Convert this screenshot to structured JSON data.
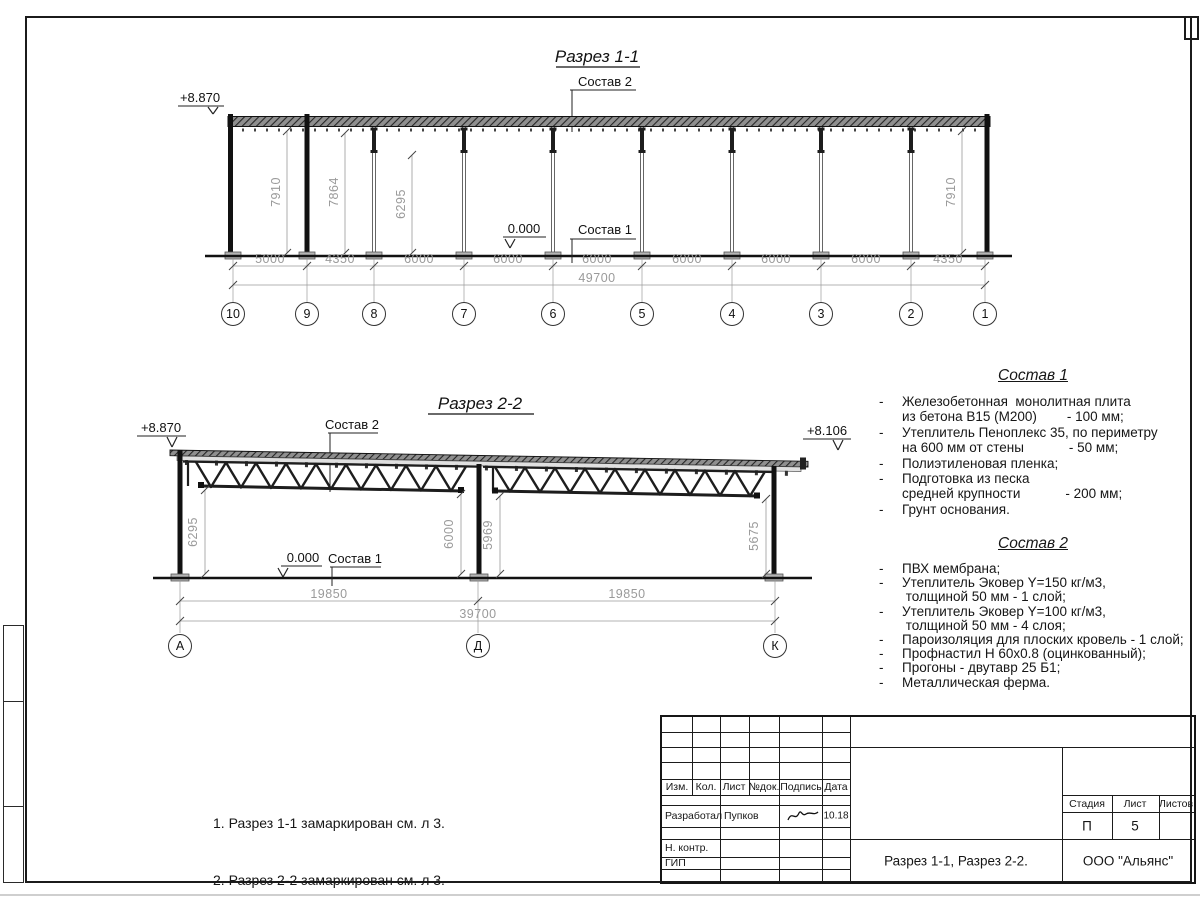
{
  "section11": {
    "title": "Разрез 1-1",
    "leader_top": "Состав 2",
    "leader_floor": "Состав 1",
    "elev_top": "+8.870",
    "elev_zero": "0.000",
    "dims_vertical": [
      "7910",
      "7864",
      "6295",
      "7910"
    ],
    "dims_bottom": [
      "5000",
      "4350",
      "6000",
      "6000",
      "6000",
      "6000",
      "6000",
      "6000",
      "4350"
    ],
    "dim_total": "49700",
    "axes": [
      "10",
      "9",
      "8",
      "7",
      "6",
      "5",
      "4",
      "3",
      "2",
      "1"
    ]
  },
  "section22": {
    "title": "Разрез 2-2",
    "leader_top": "Состав 2",
    "leader_floor": "Состав 1",
    "elev_left": "+8.870",
    "elev_right": "+8.106",
    "elev_zero": "0.000",
    "dims_vertical": [
      "6295",
      "6000",
      "5969",
      "5675"
    ],
    "dims_bottom": [
      "19850",
      "19850"
    ],
    "dim_total": "39700",
    "axes": [
      "А",
      "Д",
      "К"
    ]
  },
  "sostav1": {
    "title": "Состав 1",
    "rows": [
      {
        "b": "-",
        "t": "Железобетонная  монолитная плита"
      },
      {
        "b": "",
        "t": "из бетона В15 (М200)        - 100 мм;"
      },
      {
        "b": "-",
        "t": "Утеплитель Пеноплекс 35, по периметру"
      },
      {
        "b": "",
        "t": "на 600 мм от стены            - 50 мм;"
      },
      {
        "b": "-",
        "t": "Полиэтиленовая пленка;"
      },
      {
        "b": "-",
        "t": "Подготовка из песка"
      },
      {
        "b": "",
        "t": "средней крупности            - 200 мм;"
      },
      {
        "b": "-",
        "t": "Грунт основания."
      }
    ]
  },
  "sostav2": {
    "title": "Состав 2",
    "rows": [
      {
        "b": "-",
        "t": "ПВХ мембрана;"
      },
      {
        "b": "-",
        "t": "Утеплитель Эковер Y=150 кг/м3,"
      },
      {
        "b": "",
        "t": " толщиной 50 мм - 1 слой;"
      },
      {
        "b": "-",
        "t": "Утеплитель Эковер Y=100 кг/м3,"
      },
      {
        "b": "",
        "t": " толщиной 50 мм - 4 слоя;"
      },
      {
        "b": "-",
        "t": "Пароизоляция для плоских кровель - 1 слой;"
      },
      {
        "b": "-",
        "t": "Профнастил Н 60х0.8 (оцинкованный);"
      },
      {
        "b": "-",
        "t": "Прогоны - двутавр 25 Б1;"
      },
      {
        "b": "-",
        "t": "Металлическая ферма."
      }
    ]
  },
  "notes": {
    "line1": "1. Разрез 1-1 замаркирован см. л 3.",
    "line2": "2. Разрез 2-2 замаркирован см. л 3."
  },
  "titleblock": {
    "header_cols": [
      "Изм.",
      "Кол.",
      "Лист",
      "№док.",
      "Подпись",
      "Дата"
    ],
    "row_developer_label": "Разработал",
    "row_developer_name": "Пупков",
    "row_developer_date": "10.18",
    "row_ncontr": "Н. контр.",
    "row_gip": "ГИП",
    "stage_label": "Стадия",
    "sheet_label": "Лист",
    "sheets_label": "Листов",
    "stage": "П",
    "sheet_no": "5",
    "doc_title": "Разрез 1-1, Разрез 2-2.",
    "company": "ООО \"Альянс\""
  }
}
